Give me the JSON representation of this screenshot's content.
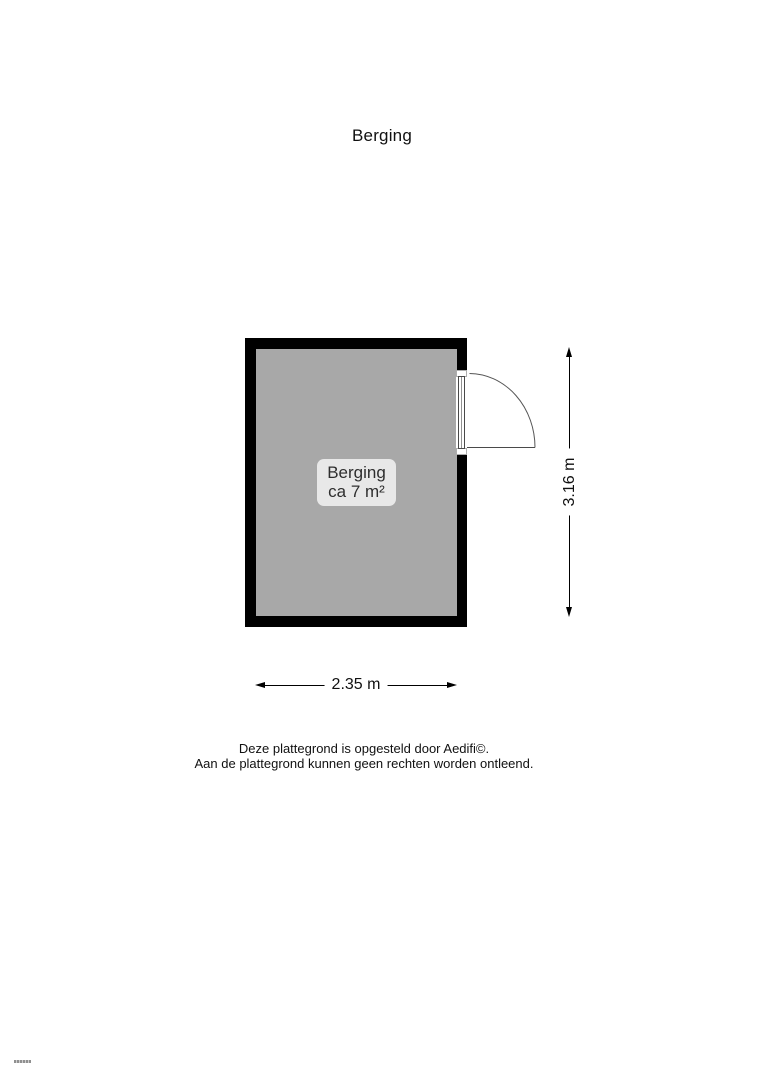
{
  "page": {
    "title": "Berging",
    "background_color": "#ffffff"
  },
  "floor_plan": {
    "room": {
      "name": "Berging",
      "area_label": "ca 7 m²",
      "floor_color": "#a8a8a8",
      "wall_color": "#000000",
      "label_background": "#e8e8e8"
    },
    "door": {
      "type": "hinged-door",
      "wall": "right",
      "swing": "outward-right"
    },
    "dimensions": {
      "height_label": "3.16 m",
      "width_label": "2.35 m"
    }
  },
  "footer": {
    "line1": "Deze plattegrond is opgesteld door Aedifi©.",
    "line2": "Aan de plattegrond kunnen geen rechten worden ontleend."
  }
}
